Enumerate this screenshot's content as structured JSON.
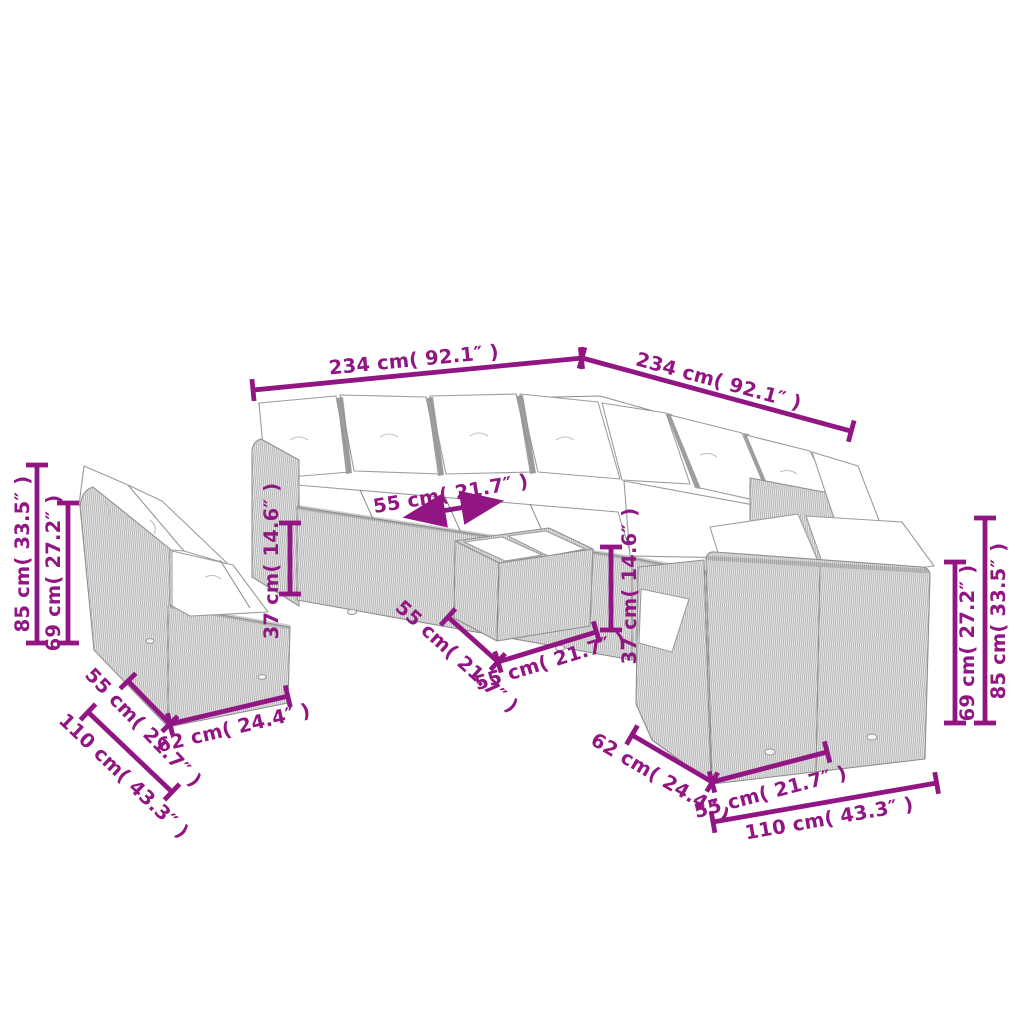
{
  "figure": {
    "type": "product-dimension-diagram",
    "subject": "Poly rattan garden lounge set (corner sofa, two 2-seater sofas, coffee table) with cushions"
  },
  "colors": {
    "dimension_annotation": "#911582",
    "line_art": "#9c9c9c",
    "background": "#ffffff"
  },
  "dimensions": {
    "top_width_left": "234 cm( 92.1″ )",
    "top_width_right": "234 cm( 92.1″ )",
    "left_overall_height": "85 cm( 33.5″ )",
    "left_backrest_height": "69 cm( 27.2″ )",
    "seat_depth": "55 cm( 21.7″ )",
    "seat_height": "37 cm( 14.6″ )",
    "table_depth": "55 cm( 21.7″ )",
    "table_width": "55 cm( 21.7″ )",
    "table_height": "37 cm( 14.6″ )",
    "left_sofa_side_depth": "55 cm( 21.7″ )",
    "left_sofa_seat_width": "62 cm( 24.4″ )",
    "left_sofa_overall_width": "110 cm( 43.3″ )",
    "right_sofa_side_depth": "62 cm( 24.4″ )",
    "right_sofa_seat_width": "55 cm( 21.7″ )",
    "right_sofa_overall_width": "110 cm( 43.3″ )",
    "right_backrest_height": "69 cm( 27.2″ )",
    "right_overall_height": "85 cm( 33.5″ )"
  }
}
